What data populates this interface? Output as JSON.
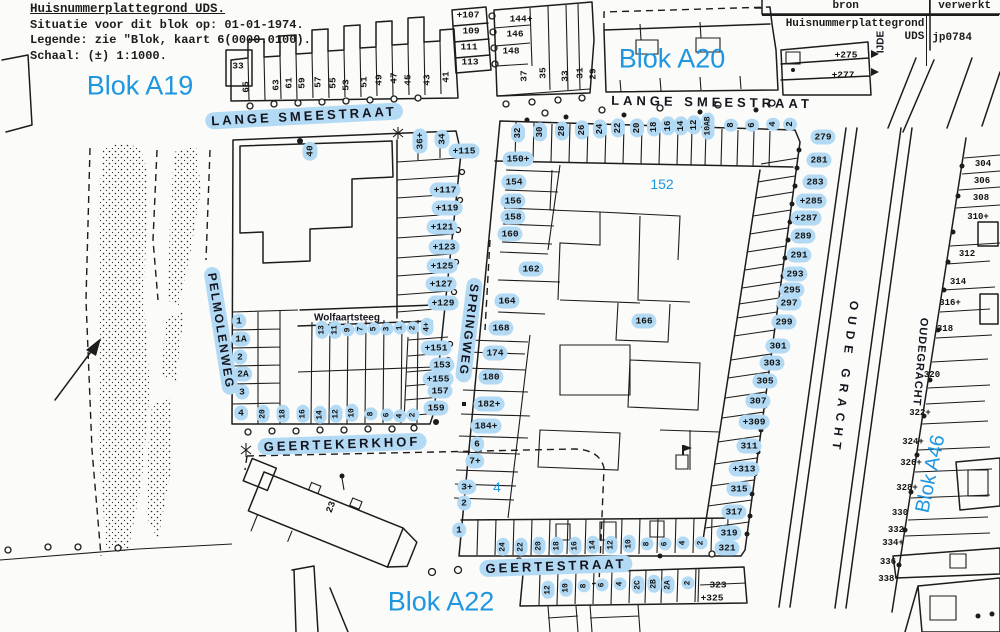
{
  "colors": {
    "annotation_blue": "#1e96e0",
    "highlight_blue": "#b3daf4",
    "ink": "#1c1c1c",
    "paper": "#fbfbf9"
  },
  "header": {
    "title": "Huisnummerplattegrond UDS.",
    "line2": "Situatie voor dit blok op: 01-01-1974.",
    "line3": "Legende: zie \"Blok, kaart 6(0000.0100).",
    "line4": "Schaal: (±) 1:1000."
  },
  "source_table": {
    "col1": "bron",
    "col2": "verwerkt",
    "bron_line1": "Huisnummerplattegrond",
    "bron_line2": "UDS",
    "verwerkt_value": "jp0784"
  },
  "map": {
    "blok_labels": [
      {
        "t": "Blok A19",
        "x": 140,
        "y": 86,
        "fs": 27
      },
      {
        "t": "Blok A20",
        "x": 672,
        "y": 59,
        "fs": 27
      },
      {
        "t": "Blok A22",
        "x": 441,
        "y": 602,
        "fs": 27
      },
      {
        "t": "Blok A46",
        "x": 931,
        "y": 474,
        "fs": 20,
        "r": -78
      },
      {
        "t": "152",
        "x": 662,
        "y": 184,
        "fs": 14
      },
      {
        "t": "4",
        "x": 497,
        "y": 487,
        "fs": 14
      }
    ],
    "street_labels": [
      {
        "t": "LANGE SMEESTRAAT",
        "x": 304,
        "y": 116,
        "r": -3,
        "fs": 13,
        "ls": 3,
        "h": true
      },
      {
        "t": "LANGE SMEESTRAAT",
        "x": 712,
        "y": 102,
        "r": 1,
        "fs": 13,
        "ls": 4
      },
      {
        "t": "PELMOLENWEG",
        "x": 221,
        "y": 331,
        "r": 81,
        "fs": 12,
        "ls": 2,
        "h": true
      },
      {
        "t": "SPRINGWEG",
        "x": 469,
        "y": 330,
        "r": 97,
        "fs": 12,
        "ls": 2,
        "h": true
      },
      {
        "t": "Wolfaartsteeg",
        "x": 347,
        "y": 318,
        "fs": 10
      },
      {
        "t": "GEERTEKERKHOF",
        "x": 342,
        "y": 444,
        "r": -2,
        "fs": 13,
        "ls": 3,
        "h": true
      },
      {
        "t": "GEERTESTRAAT",
        "x": 556,
        "y": 566,
        "r": -2,
        "fs": 13,
        "ls": 3,
        "h": true
      },
      {
        "t": "OUDE GRACHT",
        "x": 845,
        "y": 378,
        "r": 97,
        "fs": 12,
        "ls": 6
      },
      {
        "t": "OUDEGRACHT",
        "x": 920,
        "y": 362,
        "r": 95,
        "fs": 11,
        "ls": 1
      },
      {
        "t": "IJDE",
        "x": 881,
        "y": 42,
        "r": -90,
        "fs": 10
      }
    ],
    "house_numbers": [
      {
        "t": "33",
        "x": 238,
        "y": 66
      },
      {
        "t": "65",
        "x": 246,
        "y": 87,
        "r": -90
      },
      {
        "t": "63",
        "x": 276,
        "y": 85,
        "r": -90
      },
      {
        "t": "61",
        "x": 289,
        "y": 83,
        "r": -90
      },
      {
        "t": "59",
        "x": 302,
        "y": 83,
        "r": -90
      },
      {
        "t": "57",
        "x": 318,
        "y": 82,
        "r": -90
      },
      {
        "t": "55",
        "x": 333,
        "y": 83,
        "r": -90
      },
      {
        "t": "53",
        "x": 346,
        "y": 85,
        "r": -90
      },
      {
        "t": "51",
        "x": 364,
        "y": 82,
        "r": -90
      },
      {
        "t": "49",
        "x": 379,
        "y": 80,
        "r": -90
      },
      {
        "t": "47",
        "x": 394,
        "y": 78,
        "r": -90
      },
      {
        "t": "45",
        "x": 408,
        "y": 80,
        "r": -90
      },
      {
        "t": "43",
        "x": 427,
        "y": 80,
        "r": -90
      },
      {
        "t": "41",
        "x": 446,
        "y": 77,
        "r": -90
      },
      {
        "t": "+107",
        "x": 468,
        "y": 15
      },
      {
        "t": "109",
        "x": 471,
        "y": 31
      },
      {
        "t": "111",
        "x": 469,
        "y": 47
      },
      {
        "t": "113",
        "x": 470,
        "y": 62
      },
      {
        "t": "144+",
        "x": 521,
        "y": 19
      },
      {
        "t": "146",
        "x": 515,
        "y": 34
      },
      {
        "t": "148",
        "x": 511,
        "y": 51
      },
      {
        "t": "37",
        "x": 524,
        "y": 76,
        "r": -90
      },
      {
        "t": "35",
        "x": 543,
        "y": 73,
        "r": -90
      },
      {
        "t": "33",
        "x": 565,
        "y": 76,
        "r": -90
      },
      {
        "t": "31",
        "x": 580,
        "y": 73,
        "r": -90
      },
      {
        "t": "29",
        "x": 593,
        "y": 74,
        "r": -90
      },
      {
        "t": "+275",
        "x": 846,
        "y": 55
      },
      {
        "t": "+277",
        "x": 843,
        "y": 75
      },
      {
        "t": "40",
        "x": 310,
        "y": 151,
        "r": -90,
        "h": true
      },
      {
        "t": "36+",
        "x": 420,
        "y": 141,
        "r": -90,
        "h": true
      },
      {
        "t": "34",
        "x": 442,
        "y": 139,
        "r": -90,
        "h": true
      },
      {
        "t": "+115",
        "x": 464,
        "y": 151,
        "h": true
      },
      {
        "t": "+117",
        "x": 445,
        "y": 190,
        "h": true
      },
      {
        "t": "+119",
        "x": 447,
        "y": 208,
        "h": true
      },
      {
        "t": "+121",
        "x": 442,
        "y": 227,
        "h": true
      },
      {
        "t": "+123",
        "x": 444,
        "y": 247,
        "h": true
      },
      {
        "t": "+125",
        "x": 442,
        "y": 266,
        "h": true
      },
      {
        "t": "+127",
        "x": 441,
        "y": 284,
        "h": true
      },
      {
        "t": "+129",
        "x": 443,
        "y": 303,
        "h": true
      },
      {
        "t": "+151",
        "x": 436,
        "y": 348,
        "h": true
      },
      {
        "t": "153",
        "x": 442,
        "y": 365,
        "h": true
      },
      {
        "t": "+155",
        "x": 438,
        "y": 379,
        "h": true
      },
      {
        "t": "157",
        "x": 440,
        "y": 391,
        "h": true
      },
      {
        "t": "159",
        "x": 436,
        "y": 408,
        "h": true
      },
      {
        "t": "13",
        "x": 322,
        "y": 330,
        "r": -90,
        "h": true,
        "fs": 8
      },
      {
        "t": "11",
        "x": 335,
        "y": 330,
        "r": -90,
        "h": true,
        "fs": 8
      },
      {
        "t": "9",
        "x": 348,
        "y": 330,
        "r": -90,
        "h": true,
        "fs": 8
      },
      {
        "t": "7",
        "x": 361,
        "y": 329,
        "r": -90,
        "h": true,
        "fs": 8
      },
      {
        "t": "5",
        "x": 374,
        "y": 329,
        "r": -90,
        "h": true,
        "fs": 8
      },
      {
        "t": "3",
        "x": 387,
        "y": 329,
        "r": -90,
        "h": true,
        "fs": 8
      },
      {
        "t": "1",
        "x": 400,
        "y": 328,
        "r": -90,
        "h": true,
        "fs": 8
      },
      {
        "t": "2",
        "x": 413,
        "y": 328,
        "r": -90,
        "h": true,
        "fs": 8
      },
      {
        "t": "4+",
        "x": 427,
        "y": 327,
        "r": -90,
        "h": true,
        "fs": 8
      },
      {
        "t": "1",
        "x": 239,
        "y": 321,
        "h": true
      },
      {
        "t": "1A",
        "x": 241,
        "y": 339,
        "h": true
      },
      {
        "t": "2",
        "x": 240,
        "y": 357,
        "h": true
      },
      {
        "t": "2A",
        "x": 243,
        "y": 374,
        "h": true
      },
      {
        "t": "3",
        "x": 242,
        "y": 392,
        "h": true
      },
      {
        "t": "4",
        "x": 241,
        "y": 413,
        "h": true
      },
      {
        "t": "20",
        "x": 263,
        "y": 414,
        "r": -90,
        "h": true,
        "fs": 8
      },
      {
        "t": "18",
        "x": 283,
        "y": 414,
        "r": -90,
        "h": true,
        "fs": 8
      },
      {
        "t": "16",
        "x": 303,
        "y": 414,
        "r": -90,
        "h": true,
        "fs": 8
      },
      {
        "t": "14",
        "x": 320,
        "y": 415,
        "r": -90,
        "h": true,
        "fs": 8
      },
      {
        "t": "12",
        "x": 336,
        "y": 414,
        "r": -90,
        "h": true,
        "fs": 8
      },
      {
        "t": "10",
        "x": 352,
        "y": 413,
        "r": -90,
        "h": true,
        "fs": 8
      },
      {
        "t": "8",
        "x": 371,
        "y": 414,
        "r": -90,
        "h": true,
        "fs": 8
      },
      {
        "t": "6",
        "x": 387,
        "y": 415,
        "r": -90,
        "h": true,
        "fs": 8
      },
      {
        "t": "4",
        "x": 400,
        "y": 416,
        "r": -90,
        "h": true,
        "fs": 8
      },
      {
        "t": "2",
        "x": 413,
        "y": 415,
        "r": -90,
        "h": true,
        "fs": 8
      },
      {
        "t": "32",
        "x": 518,
        "y": 133,
        "r": -90,
        "h": true,
        "fs": 9
      },
      {
        "t": "30",
        "x": 540,
        "y": 132,
        "r": -90,
        "h": true,
        "fs": 9
      },
      {
        "t": "28",
        "x": 562,
        "y": 131,
        "r": -90,
        "h": true,
        "fs": 9
      },
      {
        "t": "26",
        "x": 582,
        "y": 130,
        "r": -90,
        "h": true,
        "fs": 9
      },
      {
        "t": "24",
        "x": 600,
        "y": 129,
        "r": -90,
        "h": true,
        "fs": 9
      },
      {
        "t": "22",
        "x": 618,
        "y": 128,
        "r": -90,
        "h": true,
        "fs": 9
      },
      {
        "t": "20",
        "x": 637,
        "y": 128,
        "r": -90,
        "h": true,
        "fs": 9
      },
      {
        "t": "18",
        "x": 654,
        "y": 127,
        "r": -90,
        "h": true,
        "fs": 9
      },
      {
        "t": "16",
        "x": 668,
        "y": 126,
        "r": -90,
        "h": true,
        "fs": 9
      },
      {
        "t": "14",
        "x": 681,
        "y": 126,
        "r": -90,
        "h": true,
        "fs": 9
      },
      {
        "t": "12",
        "x": 694,
        "y": 125,
        "r": -90,
        "h": true,
        "fs": 9
      },
      {
        "t": "10AB",
        "x": 708,
        "y": 126,
        "r": -90,
        "h": true,
        "fs": 8
      },
      {
        "t": "8",
        "x": 731,
        "y": 125,
        "r": -90,
        "h": true,
        "fs": 9
      },
      {
        "t": "6",
        "x": 752,
        "y": 125,
        "r": -90,
        "h": true,
        "fs": 9
      },
      {
        "t": "4",
        "x": 773,
        "y": 124,
        "r": -90,
        "h": true,
        "fs": 9
      },
      {
        "t": "2",
        "x": 790,
        "y": 124,
        "r": -90,
        "h": true,
        "fs": 9
      },
      {
        "t": "150+",
        "x": 518,
        "y": 159,
        "h": true
      },
      {
        "t": "154",
        "x": 514,
        "y": 182,
        "h": true
      },
      {
        "t": "156",
        "x": 513,
        "y": 201,
        "h": true
      },
      {
        "t": "158",
        "x": 513,
        "y": 217,
        "h": true
      },
      {
        "t": "160",
        "x": 510,
        "y": 234,
        "h": true
      },
      {
        "t": "162",
        "x": 531,
        "y": 269,
        "h": true
      },
      {
        "t": "164",
        "x": 507,
        "y": 301,
        "h": true
      },
      {
        "t": "166",
        "x": 644,
        "y": 321,
        "h": true
      },
      {
        "t": "168",
        "x": 501,
        "y": 328,
        "h": true
      },
      {
        "t": "174",
        "x": 495,
        "y": 353,
        "h": true
      },
      {
        "t": "180",
        "x": 491,
        "y": 377,
        "h": true
      },
      {
        "t": "182+",
        "x": 489,
        "y": 404,
        "h": true
      },
      {
        "t": "184+",
        "x": 486,
        "y": 426,
        "h": true
      },
      {
        "t": "6",
        "x": 477,
        "y": 444,
        "h": true
      },
      {
        "t": "7+",
        "x": 475,
        "y": 461,
        "h": true
      },
      {
        "t": "3+",
        "x": 467,
        "y": 487,
        "h": true
      },
      {
        "t": "2",
        "x": 464,
        "y": 503,
        "h": true
      },
      {
        "t": "1",
        "x": 459,
        "y": 530,
        "h": true
      },
      {
        "t": "279",
        "x": 823,
        "y": 137,
        "h": true
      },
      {
        "t": "281",
        "x": 819,
        "y": 160,
        "h": true
      },
      {
        "t": "283",
        "x": 815,
        "y": 182,
        "h": true
      },
      {
        "t": "+285",
        "x": 811,
        "y": 201,
        "h": true
      },
      {
        "t": "+287",
        "x": 806,
        "y": 218,
        "h": true
      },
      {
        "t": "289",
        "x": 803,
        "y": 236,
        "h": true
      },
      {
        "t": "291",
        "x": 799,
        "y": 255,
        "h": true
      },
      {
        "t": "293",
        "x": 795,
        "y": 274,
        "h": true
      },
      {
        "t": "295",
        "x": 792,
        "y": 290,
        "h": true
      },
      {
        "t": "297",
        "x": 789,
        "y": 303,
        "h": true
      },
      {
        "t": "299",
        "x": 784,
        "y": 322,
        "h": true
      },
      {
        "t": "301",
        "x": 778,
        "y": 346,
        "h": true
      },
      {
        "t": "303",
        "x": 772,
        "y": 363,
        "h": true
      },
      {
        "t": "305",
        "x": 765,
        "y": 381,
        "h": true
      },
      {
        "t": "307",
        "x": 758,
        "y": 401,
        "h": true
      },
      {
        "t": "+309",
        "x": 754,
        "y": 422,
        "h": true
      },
      {
        "t": "311",
        "x": 749,
        "y": 446,
        "h": true
      },
      {
        "t": "+313",
        "x": 744,
        "y": 469,
        "h": true
      },
      {
        "t": "315",
        "x": 739,
        "y": 489,
        "h": true
      },
      {
        "t": "317",
        "x": 734,
        "y": 512,
        "h": true
      },
      {
        "t": "319",
        "x": 729,
        "y": 533,
        "h": true
      },
      {
        "t": "321",
        "x": 727,
        "y": 548,
        "h": true
      },
      {
        "t": "323",
        "x": 718,
        "y": 585
      },
      {
        "t": "+325",
        "x": 712,
        "y": 598
      },
      {
        "t": "24",
        "x": 503,
        "y": 547,
        "r": -90,
        "h": true,
        "fs": 8
      },
      {
        "t": "22",
        "x": 521,
        "y": 547,
        "r": -90,
        "h": true,
        "fs": 8
      },
      {
        "t": "20",
        "x": 539,
        "y": 546,
        "r": -90,
        "h": true,
        "fs": 8
      },
      {
        "t": "18",
        "x": 557,
        "y": 546,
        "r": -90,
        "h": true,
        "fs": 8
      },
      {
        "t": "16",
        "x": 575,
        "y": 546,
        "r": -90,
        "h": true,
        "fs": 8
      },
      {
        "t": "14",
        "x": 593,
        "y": 545,
        "r": -90,
        "h": true,
        "fs": 8
      },
      {
        "t": "12",
        "x": 611,
        "y": 545,
        "r": -90,
        "h": true,
        "fs": 8
      },
      {
        "t": "10",
        "x": 629,
        "y": 544,
        "r": -90,
        "h": true,
        "fs": 8
      },
      {
        "t": "8",
        "x": 647,
        "y": 544,
        "r": -90,
        "h": true,
        "fs": 8
      },
      {
        "t": "6",
        "x": 665,
        "y": 544,
        "r": -90,
        "h": true,
        "fs": 8
      },
      {
        "t": "4",
        "x": 683,
        "y": 543,
        "r": -90,
        "h": true,
        "fs": 8
      },
      {
        "t": "2",
        "x": 701,
        "y": 543,
        "r": -90,
        "h": true,
        "fs": 8
      },
      {
        "t": "12",
        "x": 548,
        "y": 590,
        "r": -90,
        "h": true,
        "fs": 8
      },
      {
        "t": "10",
        "x": 566,
        "y": 588,
        "r": -90,
        "h": true,
        "fs": 8
      },
      {
        "t": "8",
        "x": 584,
        "y": 586,
        "r": -90,
        "h": true,
        "fs": 8
      },
      {
        "t": "6",
        "x": 602,
        "y": 585,
        "r": -90,
        "h": true,
        "fs": 8
      },
      {
        "t": "4",
        "x": 620,
        "y": 584,
        "r": -90,
        "h": true,
        "fs": 8
      },
      {
        "t": "2C",
        "x": 638,
        "y": 585,
        "r": -90,
        "h": true,
        "fs": 8
      },
      {
        "t": "2B",
        "x": 654,
        "y": 584,
        "r": -90,
        "h": true,
        "fs": 8
      },
      {
        "t": "2A",
        "x": 668,
        "y": 585,
        "r": -90,
        "h": true,
        "fs": 8
      },
      {
        "t": "2",
        "x": 688,
        "y": 583,
        "r": -90,
        "h": true,
        "fs": 8
      },
      {
        "t": "304",
        "x": 983,
        "y": 164,
        "fs": 9
      },
      {
        "t": "306",
        "x": 982,
        "y": 181,
        "fs": 9
      },
      {
        "t": "308",
        "x": 981,
        "y": 198,
        "fs": 9
      },
      {
        "t": "310+",
        "x": 978,
        "y": 217,
        "fs": 9
      },
      {
        "t": "312",
        "x": 967,
        "y": 254,
        "fs": 9
      },
      {
        "t": "314",
        "x": 958,
        "y": 282,
        "fs": 9
      },
      {
        "t": "316+",
        "x": 950,
        "y": 303,
        "fs": 9
      },
      {
        "t": "318",
        "x": 945,
        "y": 329,
        "fs": 9
      },
      {
        "t": "320",
        "x": 932,
        "y": 375,
        "fs": 9
      },
      {
        "t": "322+",
        "x": 920,
        "y": 413,
        "fs": 9
      },
      {
        "t": "324+",
        "x": 913,
        "y": 442,
        "fs": 9
      },
      {
        "t": "326+",
        "x": 911,
        "y": 463,
        "fs": 9
      },
      {
        "t": "328+",
        "x": 907,
        "y": 488,
        "fs": 9
      },
      {
        "t": "330",
        "x": 900,
        "y": 513,
        "fs": 9
      },
      {
        "t": "332",
        "x": 896,
        "y": 530,
        "fs": 9
      },
      {
        "t": "334+",
        "x": 893,
        "y": 543,
        "fs": 9
      },
      {
        "t": "336",
        "x": 888,
        "y": 562,
        "fs": 9
      },
      {
        "t": "338+",
        "x": 889,
        "y": 579,
        "fs": 9
      },
      {
        "t": "23",
        "x": 331,
        "y": 507,
        "r": -70
      }
    ]
  }
}
